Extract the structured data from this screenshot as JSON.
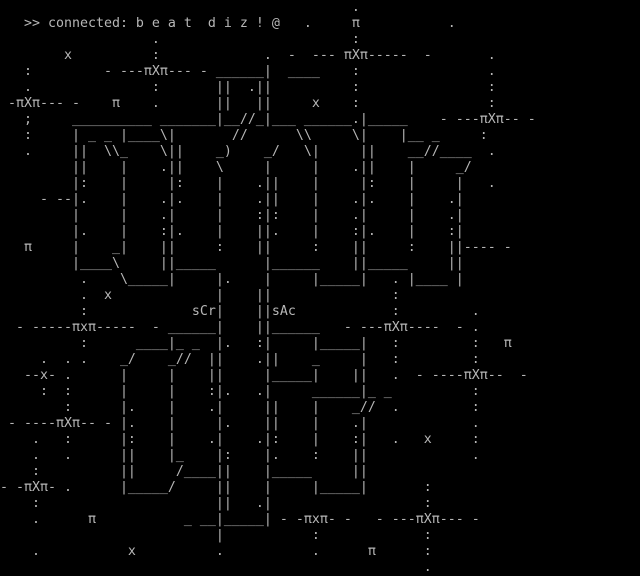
{
  "terminal": {
    "status_line": ">> connected: b e a t  d i z ! @",
    "labels": {
      "left_block": "sCr",
      "right_block": "sAc"
    },
    "colors": {
      "background": "#000000",
      "foreground": "#b7b7b7"
    },
    "grid": {
      "cols": 80,
      "rows": 36
    },
    "art_lines": [
      "                                            .",
      "   >> connected: b e a t  d i z ! @   .     π           .",
      "                   .                        :",
      "        x          :             .  -  --- πXπ-----  -       .",
      "   :         - ---πXπ--- - ______|  ____    :                .",
      "   .               :       ||  .||          :                :",
      " -πXπ--- -    π    .       ||   ||     x    :                :",
      "   ;     __________ _______|__//_|___ ______.|_____    - ---πXπ-- -",
      "   :     | _ _ |____\\|       //      \\\\     \\|    |__ _     :",
      "   .     ||  \\\\_    \\||    _)    _/   \\|     ||    __//____  .",
      "         ||    |    .||    \\     |     |    .||    |     _/",
      "         |:    |     |:    |    .||    |     |:    |     |   .",
      "     - --|.    |    .|.    |    .||    |    .|.    |    .|",
      "         |     |    .|     |    :|:    |    .|     |    .|",
      "         |.    |    :|.    |    ||.    |    :|.    |    :|",
      "   π     |    _|    ||     :    ||     :    ||     :    ||---- -",
      "         |____\\     ||_____      |______    ||_____     ||",
      "          .    \\_____|     |.    |     |_____|   . |____ |",
      "          .  x             |    ||               :",
      "          :             sCr|    ||sAc            :         .",
      "  - -----πxπ-----  - ______|    ||______   - ---πXπ----  - .",
      "          :      ____|_ _  |.   :|     |_____|   :         :   π",
      "     .  . .    _/    _//  ||    .||    _     |   :         :",
      "   --x- .      |     |    ||     |_____|    ||   .  - ----πXπ--  -",
      "     :  :      |     |    :|.   .|     ______|_ _          :",
      "        :      |.    |    .|     ||    |    _//  .         :",
      " - ----πXπ-- - |.    |     |.    ||    |    .|             .",
      "    .   :      |:    |    .|    .|:    |    :|   .   x     :",
      "    .   .      ||    |_    |:    |.    :    ||             .",
      "    :          ||     /____||    |_____     ||",
      "- -πXπ- .      |_____/     ||    |     |_____|       :",
      "    :                      ||   .|                   :",
      "    .      π           _ __|_____| - -πxπ- -   - ---πXπ--- -",
      "                           |           :             :",
      "    .           x          .           .      π      :",
      "                                                     ."
    ]
  }
}
